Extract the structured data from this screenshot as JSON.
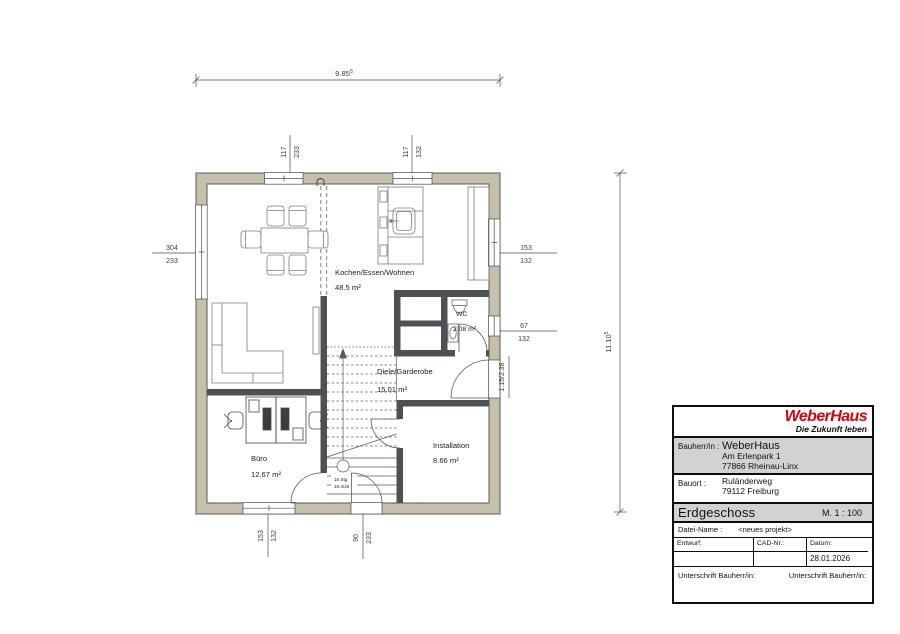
{
  "plan": {
    "rooms": {
      "living": {
        "name": "Kochen/Essen/Wohnen",
        "area": "48.5 m²"
      },
      "hall": {
        "name": "Diele/Garderobe",
        "area": "15.01 m²"
      },
      "office": {
        "name": "Büro",
        "area": "12.67 m²"
      },
      "installation": {
        "name": "Installation",
        "area": "8.66 m²"
      },
      "wc": {
        "name": "WC",
        "area": "2.08 m²"
      }
    },
    "stairs": {
      "steps": "16 Stg",
      "rise": "18.4/26"
    },
    "dimensions": {
      "width": {
        "value": "9.85",
        "sup": "5"
      },
      "height": {
        "value": "11.10",
        "sup": "5"
      },
      "top_left_opening": {
        "w": "117",
        "h": "233"
      },
      "top_right_opening": {
        "w": "117",
        "h": "132"
      },
      "left_opening": {
        "w": "304",
        "h": "233"
      },
      "right_upper_opening": {
        "w": "153",
        "h": "132"
      },
      "right_lower_opening": {
        "w": "67",
        "h": "132"
      },
      "entry_door": "1.15/2.38",
      "bottom_left_opening": {
        "w": "153",
        "h": "132"
      },
      "bottom_center_opening": {
        "w": "90",
        "h": "233"
      }
    }
  },
  "title_block": {
    "logo": "WeberHaus",
    "tagline": "Die Zukunft leben",
    "bauherr_label": "Bauherr/in :",
    "bauherr_name": "WeberHaus",
    "bauherr_addr1": "Am Erlenpark 1",
    "bauherr_addr2": "77866 Rheinau-Linx",
    "bauort_label": "Bauort :",
    "bauort_addr1": "Ruländerweg",
    "bauort_addr2": "79112 Freiburg",
    "floor": "Erdgeschoss",
    "scale": "M. 1 : 100",
    "datei_label": "Datei-Name :",
    "datei_value": "<neues projekt>",
    "entwurf_label": "Entwurf:",
    "cad_label": "CAD-Nr.:",
    "datum_label": "Datum:",
    "datum_value": "28.01.2026",
    "sig_left": "Unterschrift Bauherr/in:",
    "sig_right": "Unterschrift Bauherr/in:"
  },
  "colors": {
    "exterior_wall": "#c6bfac",
    "interior_wall": "#4d5156",
    "logo_red": "#d60210",
    "titleblock_gray": "#d2d2d2"
  }
}
